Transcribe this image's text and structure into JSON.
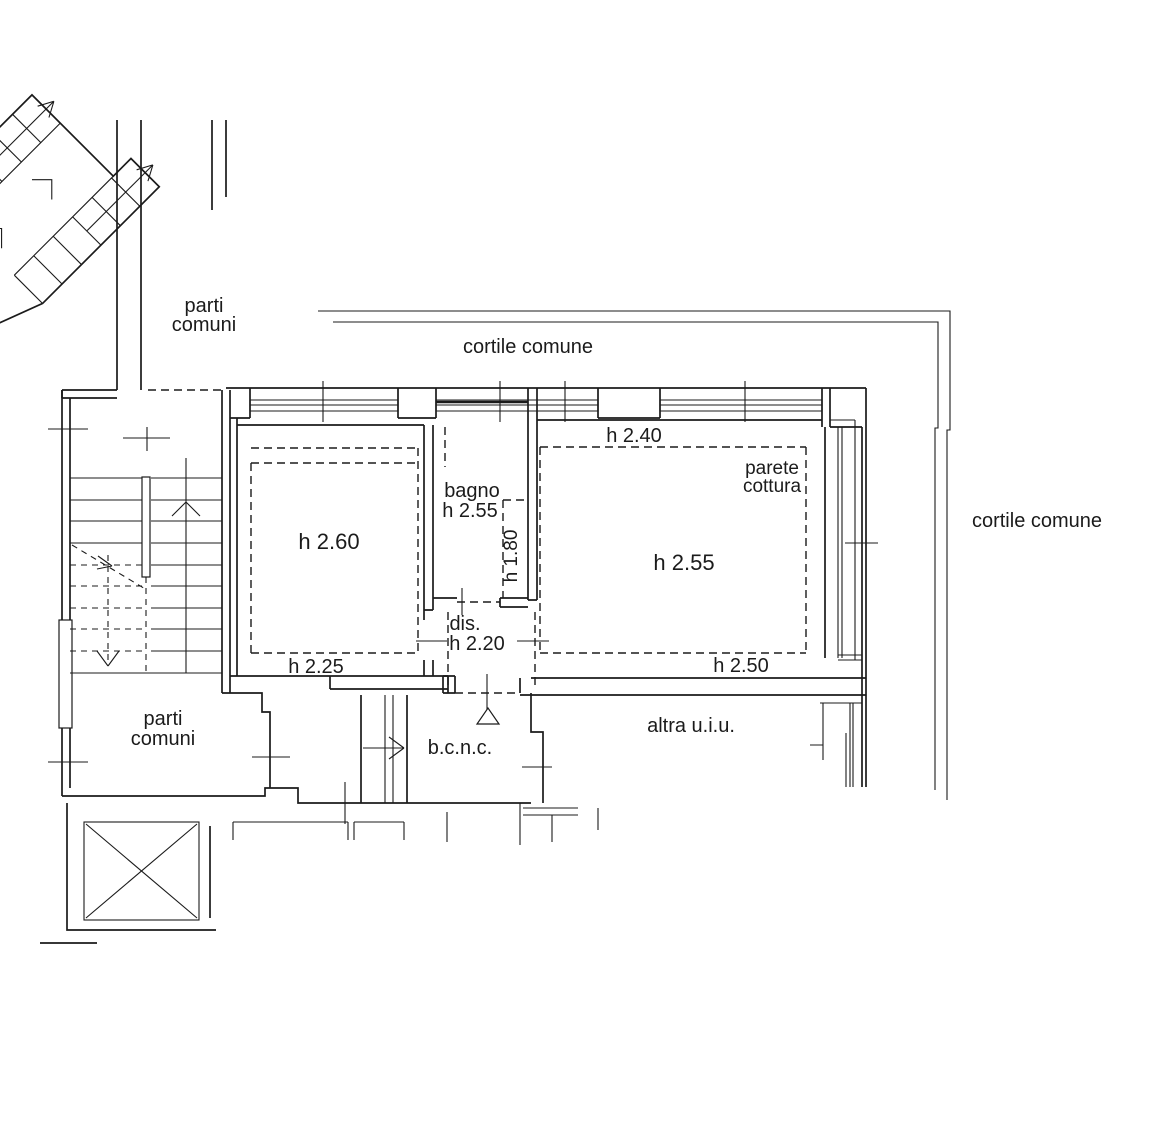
{
  "page": {
    "background": "#ffffff",
    "line_color": "#1b1b1b",
    "drawing_type": "cadastral floor plan"
  },
  "floorplan": {
    "labels": [
      {
        "id": "parti-comuni-top-1",
        "text": "parti",
        "x": 204,
        "y": 312,
        "size": 20,
        "rotate": 0
      },
      {
        "id": "parti-comuni-top-2",
        "text": "comuni",
        "x": 204,
        "y": 331,
        "size": 20,
        "rotate": 0
      },
      {
        "id": "cortile-comune-top",
        "text": "cortile comune",
        "x": 528,
        "y": 353,
        "size": 20,
        "rotate": 0
      },
      {
        "id": "cortile-comune-right",
        "text": "cortile comune",
        "x": 1037,
        "y": 527,
        "size": 20,
        "rotate": 0
      },
      {
        "id": "h-240",
        "text": "h 2.40",
        "x": 634,
        "y": 442,
        "size": 20,
        "rotate": 0
      },
      {
        "id": "parete-cottura-1",
        "text": "parete",
        "x": 772,
        "y": 474,
        "size": 19,
        "rotate": 0
      },
      {
        "id": "parete-cottura-2",
        "text": "cottura",
        "x": 772,
        "y": 492,
        "size": 19,
        "rotate": 0
      },
      {
        "id": "bagno",
        "text": "bagno",
        "x": 472,
        "y": 497,
        "size": 20,
        "rotate": 0
      },
      {
        "id": "bagno-h-255",
        "text": "h 2.55",
        "x": 470,
        "y": 517,
        "size": 20,
        "rotate": 0
      },
      {
        "id": "h-180",
        "text": "h 1.80",
        "x": 517,
        "y": 556,
        "size": 19,
        "rotate": -90
      },
      {
        "id": "h-260",
        "text": "h 2.60",
        "x": 329,
        "y": 549,
        "size": 22,
        "rotate": 0
      },
      {
        "id": "h-255",
        "text": "h 2.55",
        "x": 684,
        "y": 570,
        "size": 22,
        "rotate": 0
      },
      {
        "id": "dis",
        "text": "dis.",
        "x": 465,
        "y": 630,
        "size": 20,
        "rotate": 0
      },
      {
        "id": "h-220",
        "text": "h 2.20",
        "x": 477,
        "y": 650,
        "size": 20,
        "rotate": 0
      },
      {
        "id": "h-225",
        "text": "h 2.25",
        "x": 316,
        "y": 673,
        "size": 20,
        "rotate": 0
      },
      {
        "id": "h-250",
        "text": "h 2.50",
        "x": 741,
        "y": 672,
        "size": 20,
        "rotate": 0
      },
      {
        "id": "parti-comuni-bottom-1",
        "text": "parti",
        "x": 163,
        "y": 725,
        "size": 20,
        "rotate": 0
      },
      {
        "id": "parti-comuni-bottom-2",
        "text": "comuni",
        "x": 163,
        "y": 745,
        "size": 20,
        "rotate": 0
      },
      {
        "id": "bcnc",
        "text": "b.c.n.c.",
        "x": 460,
        "y": 754,
        "size": 20,
        "rotate": 0
      },
      {
        "id": "altra-uiu",
        "text": "altra u.i.u.",
        "x": 691,
        "y": 732,
        "size": 20,
        "rotate": 0
      }
    ],
    "symbols": [
      {
        "name": "stair-direction-arrow-upper-flight"
      },
      {
        "name": "stair-direction-arrow-lower-flight"
      },
      {
        "name": "stair-up-arrow-internal"
      },
      {
        "name": "stair-down-arrow-internal"
      },
      {
        "name": "entrance-triangle"
      },
      {
        "name": "elevator-cross"
      },
      {
        "name": "door-opening-ticks"
      }
    ]
  }
}
